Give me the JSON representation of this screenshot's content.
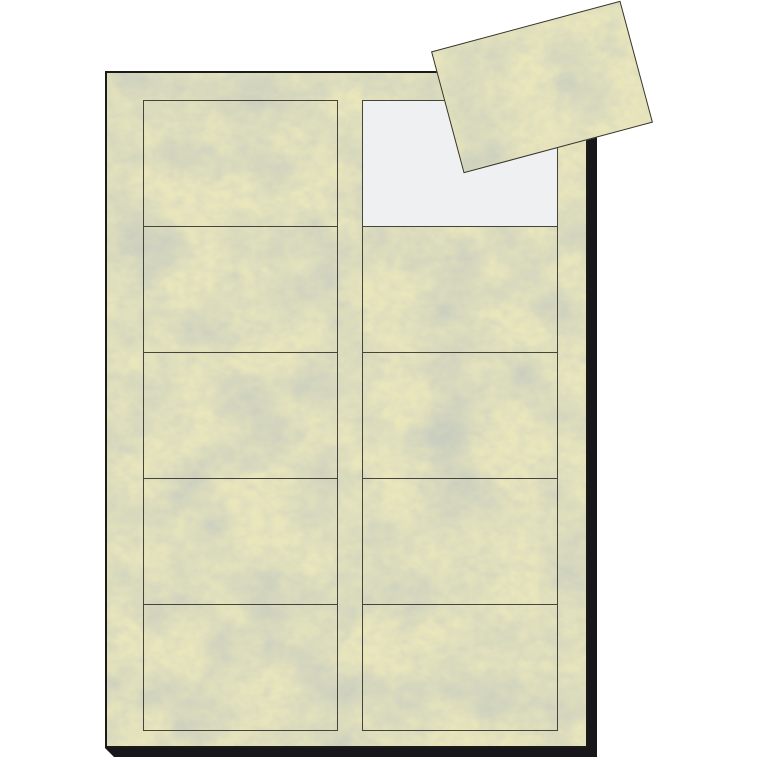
{
  "page": {
    "description": "Product photo: cream marbled business-card sheet with micro-perforated cards; one card detached and lying rotated across the top-right corner of the sheet, leaving an empty white slot.",
    "visible_text": ""
  },
  "colors": {
    "background": "#ffffff",
    "paper": "#e9e6bc",
    "vein": "#8c9584",
    "slot_empty": "#eef0f1",
    "sheet_border": "#1c1b17",
    "card_outline": "#45443a",
    "sheet_shadow": "#17161a",
    "loose_card_border": "#35342c"
  },
  "sheet": {
    "orientation": "portrait",
    "texture": "gray-green marble clouds on cream stock",
    "grid": {
      "rows": 5,
      "columns": 2,
      "total_cards": 10,
      "cards_remaining": 9,
      "removed_slot": {
        "row_index": 0,
        "col_index": 1
      }
    }
  },
  "loose_card": {
    "rotation_deg": -15,
    "position": "overlapping the sheet's top-right corner",
    "texture": "same cream marble as sheet"
  }
}
